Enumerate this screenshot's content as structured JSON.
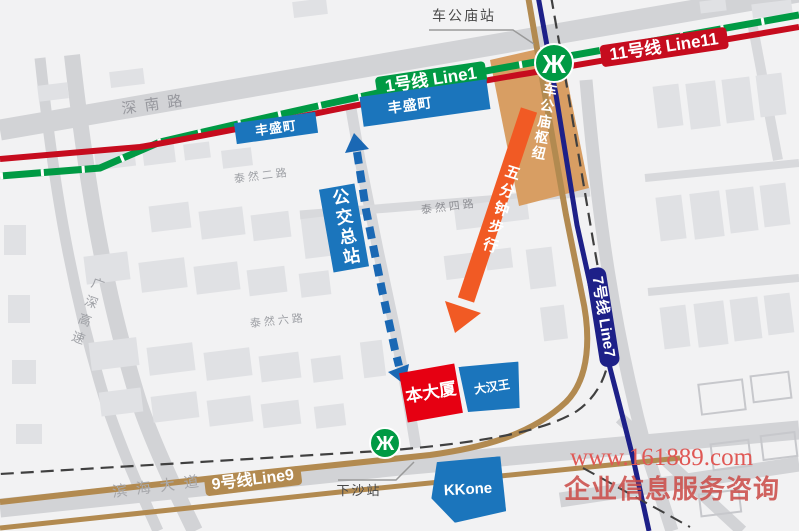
{
  "lines": {
    "line1": {
      "label": "1号线 Line1",
      "color": "#009a44"
    },
    "line7": {
      "label": "7号线 Line7",
      "color": "#1d2088"
    },
    "line9": {
      "label": "9号线Line9",
      "color": "#b28a50"
    },
    "line11": {
      "label": "11号线 Line11",
      "color": "#c60c1e"
    }
  },
  "stations": {
    "chegongmiao": "车公庙站",
    "xiasha": "下沙站"
  },
  "roads": {
    "shennan": "深南路",
    "guangshen_expressway": "广深高速",
    "tairan2": "泰然二路",
    "tairan4": "泰然四路",
    "tairan6": "泰然六路",
    "binhai": "滨海大道"
  },
  "places": {
    "fengshengding_west": "丰盛町",
    "fengshengding_east": "丰盛町",
    "chegongmiao_hub": "车公庙枢纽",
    "bus_terminal": "公交总站",
    "walk_note": "五分钟步行",
    "main_building": "本大厦",
    "dahanwang": "大汉王",
    "kkone": "KKone"
  },
  "icons": {
    "metro_logo": "Ж"
  },
  "watermark": {
    "site": "www.161889.com",
    "caption": "企业信息服务咨询"
  }
}
